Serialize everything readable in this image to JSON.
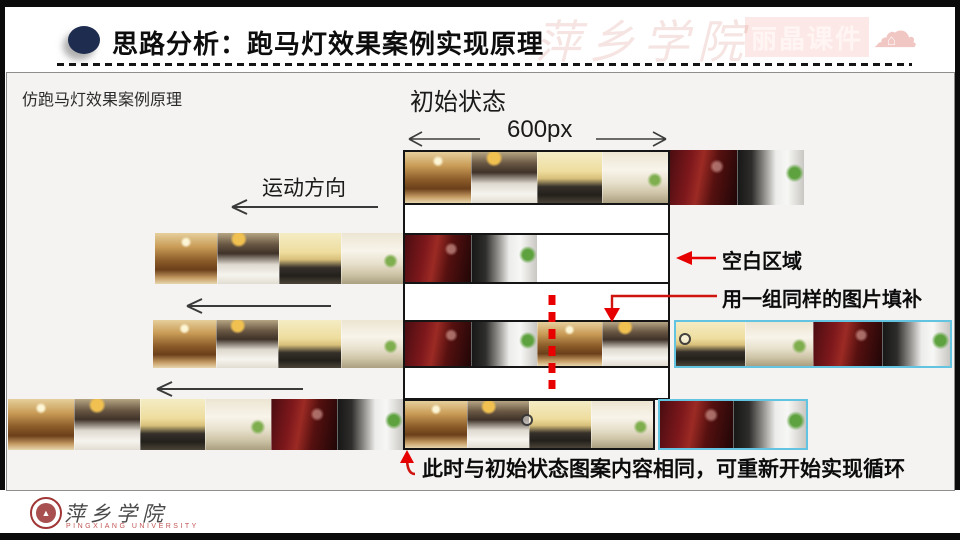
{
  "header": {
    "title": "思路分析：跑马灯效果案例实现原理",
    "watermark_script": "萍乡学院",
    "watermark_brand": "丽晶课件"
  },
  "diagram": {
    "principle_label": "仿跑马灯效果案例原理",
    "initial_state_label": "初始状态",
    "viewport_width_label": "600px",
    "direction_label": "运动方向",
    "blank_area_label": "空白区域",
    "fill_label": "用一组同样的图片填补",
    "loop_label": "此时与初始状态图案内容相同，可重新开始实现循环",
    "colors": {
      "annotation_red": "#e60000",
      "duplicate_set_border": "#62c4e0",
      "viewport_border": "#151515",
      "header_bullet": "#1e2d4f"
    },
    "tile_types": {
      "a": "gold-classic-living-room",
      "b": "white-dining-room-dark-art",
      "c": "pale-yellow-lounge-dark-floor",
      "d": "cream-hallway-with-plants",
      "e": "wine-red-lounge",
      "f": "black-white-modern-room-with-plant"
    },
    "rows": [
      {
        "name": "row-initial",
        "y": 150,
        "h": 55,
        "groups": [
          {
            "name": "viewport-strip",
            "x": 403,
            "w": 267,
            "border": "black",
            "tiles": [
              "a",
              "b",
              "c",
              "d"
            ]
          },
          {
            "name": "overflow-right-strip",
            "x": 670,
            "w": 134,
            "border": "none",
            "tiles": [
              "e",
              "f"
            ]
          }
        ]
      },
      {
        "name": "row-moved",
        "y": 233,
        "h": 51,
        "groups": [
          {
            "name": "offscreen-left-strip",
            "x": 155,
            "w": 248,
            "border": "none",
            "tiles": [
              "a",
              "b",
              "c",
              "d"
            ]
          },
          {
            "name": "viewport-strip-with-blank",
            "x": 403,
            "w": 267,
            "border": "black",
            "partial": true,
            "tile_w": 66,
            "tiles": [
              "e",
              "f"
            ]
          }
        ]
      },
      {
        "name": "row-filled",
        "y": 320,
        "h": 48,
        "groups": [
          {
            "name": "offscreen-left-strip",
            "x": 153,
            "w": 250,
            "border": "none",
            "tiles": [
              "a",
              "b",
              "c",
              "d"
            ]
          },
          {
            "name": "viewport-strip",
            "x": 403,
            "w": 267,
            "border": "black",
            "tiles": [
              "e",
              "f",
              "a",
              "b"
            ]
          },
          {
            "name": "duplicate-set-strip",
            "x": 674,
            "w": 278,
            "border": "cyan",
            "tiles": [
              "c",
              "d",
              "e",
              "f"
            ]
          }
        ],
        "marker": {
          "x": 685,
          "y": 339
        }
      },
      {
        "name": "row-looped",
        "y": 399,
        "h": 51,
        "groups": [
          {
            "name": "offscreen-left-strip",
            "x": 8,
            "w": 395,
            "border": "none",
            "tiles": [
              "a",
              "b",
              "c",
              "d",
              "e",
              "f"
            ]
          },
          {
            "name": "viewport-strip",
            "x": 403,
            "w": 252,
            "border": "black",
            "tiles": [
              "a",
              "b",
              "c",
              "d"
            ]
          },
          {
            "name": "duplicate-set-strip",
            "x": 658,
            "w": 150,
            "border": "cyan",
            "tiles": [
              "e",
              "f"
            ]
          }
        ],
        "marker": {
          "x": 527,
          "y": 420
        }
      }
    ]
  },
  "footer": {
    "university_cn": "萍乡学院",
    "university_en": "PINGXIANG UNIVERSITY"
  }
}
